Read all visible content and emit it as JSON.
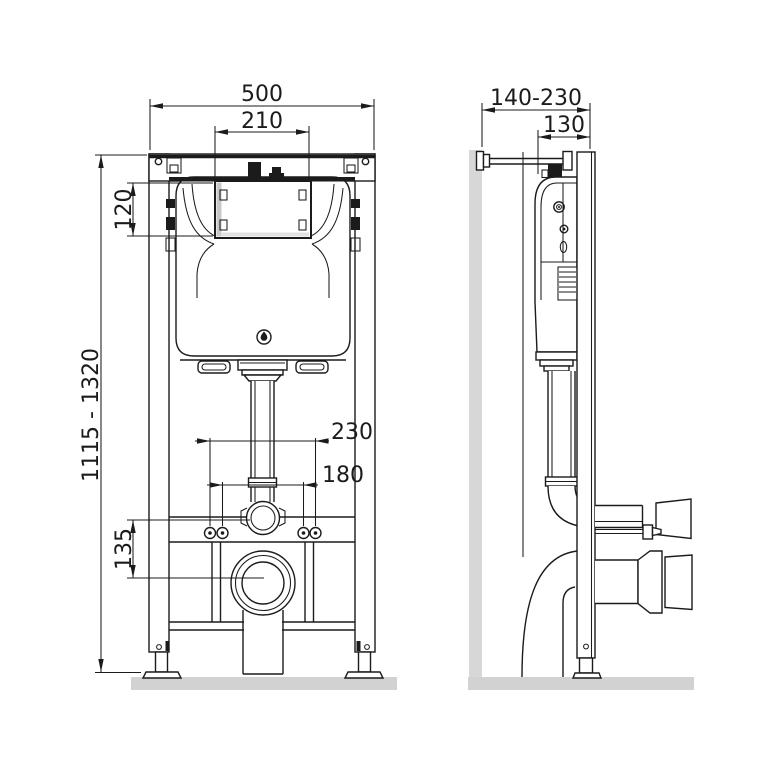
{
  "drawing": {
    "front_view": {
      "dim_overall_width": "500",
      "dim_panel_width": "210",
      "dim_panel_height": "120",
      "dim_installation_height": "1115 - 1320",
      "dim_fixing_outer": "230",
      "dim_fixing_inner": "180",
      "dim_outlet_axis": "135"
    },
    "side_view": {
      "dim_wall_distance": "140-230",
      "dim_frame_depth": "130"
    },
    "colors": {
      "line": "#1b1b1b",
      "floor": "#d2d2d2",
      "wall": "#d7d7d7",
      "panel_shade": "#c8c8c8",
      "panel_shade_light": "#e2e2e2",
      "background": "#ffffff"
    }
  }
}
